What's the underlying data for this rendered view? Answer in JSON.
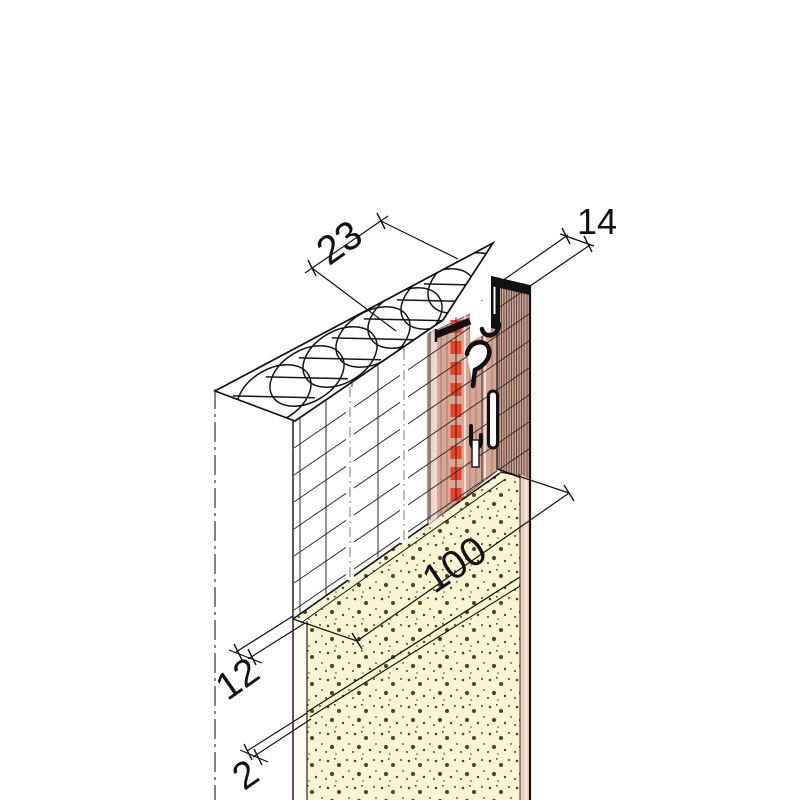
{
  "drawing": {
    "title": "plaster-profile-detail",
    "labels": {
      "insulation_width": "23",
      "profile_face_width": "14",
      "mesh_overlap": "100",
      "base_coat_thickness": "12",
      "finish_coat_thickness": "2"
    },
    "colors": {
      "render_yellow": "#f8f5d2",
      "render_pale": "#fdfcf1",
      "profile_salmon": "#d7a795",
      "profile_salmon_light": "#eed6ca",
      "stripe_band": "#cfa392",
      "edge_pink": "#eacdbf",
      "red_marker": "#ee4023",
      "line_black": "#111111",
      "mesh_line": "#2e2e2e",
      "speckle": "#4a471d",
      "stripe_dark": "#5d4a41",
      "break_gray": "#999999"
    }
  }
}
